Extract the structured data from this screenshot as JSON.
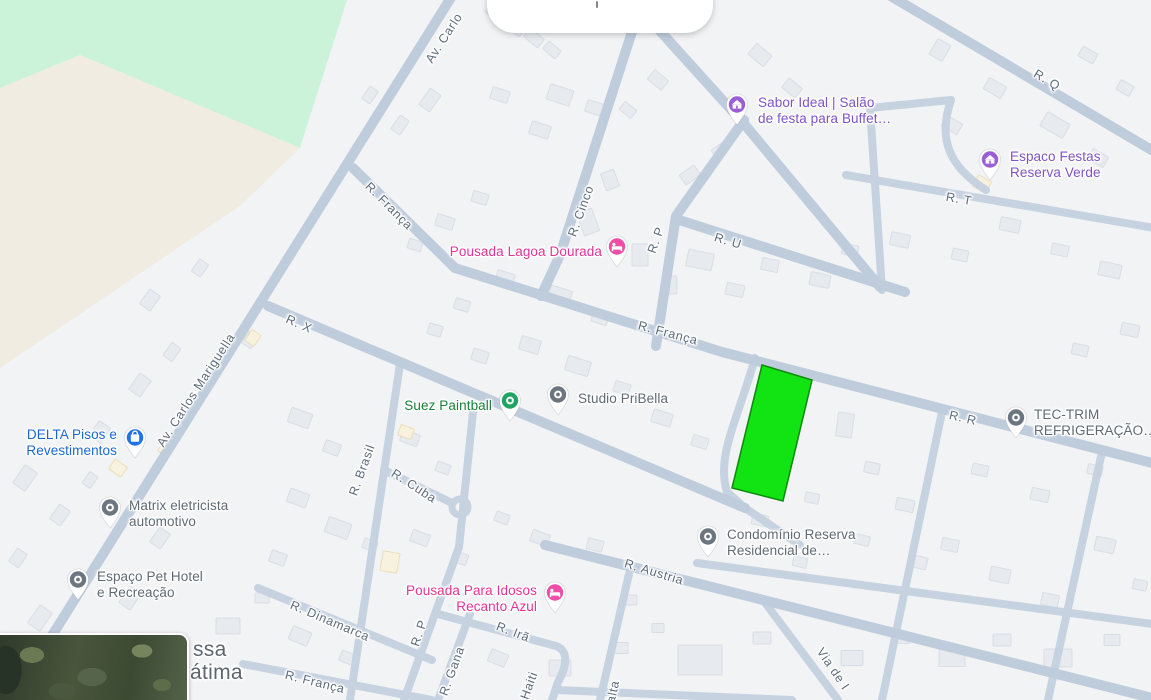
{
  "colors": {
    "map_bg": "#f2f3f5",
    "road": "#bfccdc",
    "road_minor": "#c6d2e0",
    "park": "#cbf3da",
    "terrain": "#f1ece1",
    "building": "#e7eaef",
    "building_outline": "#d9dee5",
    "commercial": "#f7f1dd",
    "lot_fill": "#12e312",
    "lot_outline": "#0c8a0c",
    "poi_purple": "#7e52c8",
    "pin_purple": "#9a5fd4",
    "poi_pink": "#e63296",
    "pin_pink": "#ef4da6",
    "poi_blue": "#1a66d9",
    "pin_blue": "#1f72e8",
    "poi_green": "#188038",
    "pin_green": "#1fa463",
    "poi_gray": "#5f6a74",
    "pin_gray": "#6b7680",
    "street_label": "#5d6b7c",
    "locality_label": "#5d6670"
  },
  "lot": {
    "points": "762,365 812,380 783,501 732,488"
  },
  "pois": [
    {
      "id": "sabor-ideal",
      "lines": [
        "Sabor Ideal | Salão",
        "de festa para Buffet…"
      ],
      "icon": "event-venue-icon"
    },
    {
      "id": "espaco-festas",
      "lines": [
        "Espaco Festas",
        "Reserva Verde"
      ],
      "icon": "event-venue-icon"
    },
    {
      "id": "pousada-lagoa-dourada",
      "lines": [
        "Pousada Lagoa Dourada"
      ],
      "icon": "lodging-icon"
    },
    {
      "id": "delta-pisos",
      "lines": [
        "DELTA Pisos e",
        "Revestimentos"
      ],
      "icon": "shopping-icon"
    },
    {
      "id": "suez-paintball",
      "lines": [
        "Suez Paintball"
      ],
      "icon": "generic-poi-icon"
    },
    {
      "id": "studio-pribella",
      "lines": [
        "Studio PriBella"
      ],
      "icon": "generic-poi-icon"
    },
    {
      "id": "tec-trim",
      "lines": [
        "TEC-TRIM",
        "REFRIGERAÇÃO…"
      ],
      "icon": "generic-poi-icon"
    },
    {
      "id": "matrix-eletricista",
      "lines": [
        "Matrix eletricista",
        "automotivo"
      ],
      "icon": "generic-poi-icon"
    },
    {
      "id": "espaco-pet",
      "lines": [
        "Espaço Pet Hotel",
        "e Recreação"
      ],
      "icon": "generic-poi-icon"
    },
    {
      "id": "pousada-recanto-azul",
      "lines": [
        "Pousada Para Idosos",
        "Recanto Azul"
      ],
      "icon": "lodging-icon"
    },
    {
      "id": "condominio-reserva",
      "lines": [
        "Condomínio Reserva",
        "Residencial de…"
      ],
      "icon": "generic-poi-icon"
    }
  ],
  "streets": [
    {
      "text": "Av. Carlo"
    },
    {
      "text": "R. França"
    },
    {
      "text": "R. Cinco"
    },
    {
      "text": "R. P"
    },
    {
      "text": "R. U"
    },
    {
      "text": "R. Q"
    },
    {
      "text": "R. T"
    },
    {
      "text": "R. França"
    },
    {
      "text": "R. R"
    },
    {
      "text": "Av. Carlos Mariguella"
    },
    {
      "text": "R. X"
    },
    {
      "text": "R. Brasil"
    },
    {
      "text": "R. Cuba"
    },
    {
      "text": "R. Dinamarca"
    },
    {
      "text": "R. França"
    },
    {
      "text": "R. P"
    },
    {
      "text": "R. Gana"
    },
    {
      "text": "R. Irã"
    },
    {
      "text": "R. Haiti"
    },
    {
      "text": "R. Malta"
    },
    {
      "text": "Via de I"
    },
    {
      "text": "R. Austria"
    }
  ],
  "locality": {
    "line1": "ssa",
    "line2": "átima"
  }
}
